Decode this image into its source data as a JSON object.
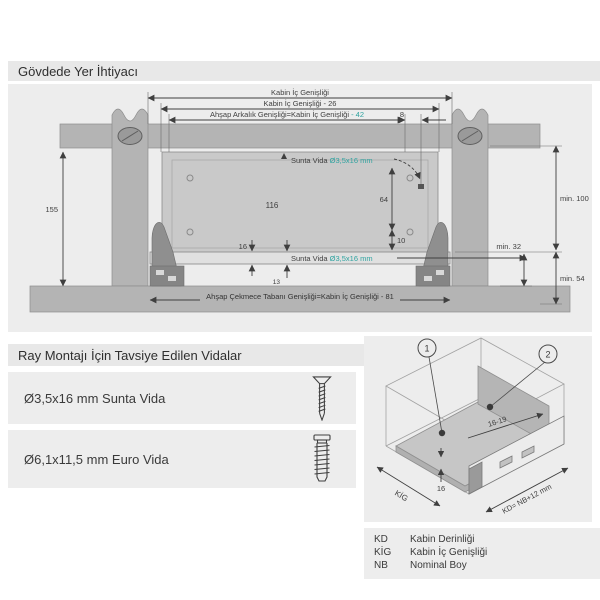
{
  "page": {
    "title": "Gövdede Yer İhtiyacı"
  },
  "drawing": {
    "top1": "Kabin İç Genişliği",
    "top2": "Kabin İç Genişliği - 26",
    "top3_main": "Ahşap Arkalık Genişliği=Kabin İç Genişliği",
    "top3_accent": " - 42",
    "dim8": "8",
    "d155": "155",
    "d116": "116",
    "d64": "64",
    "d10": "10",
    "d16": "16",
    "d13": "13",
    "min100": "min. 100",
    "min54": "min. 54",
    "min32": "min. 32",
    "sunta_prefix": "Sunta Vida ",
    "sunta_size": "Ø3,5x16 mm",
    "bottom_label": "Ahşap Çekmece Tabanı Genişliği=Kabin İç Genişliği - 81"
  },
  "screws": {
    "title": "Ray Montajı İçin Tavsiye Edilen Vidalar",
    "items": [
      {
        "label": "Ø3,5x16 mm Sunta Vida",
        "icon": "countersunk-screw-icon"
      },
      {
        "label": "Ø6,1x11,5 mm Euro Vida",
        "icon": "euro-screw-icon"
      }
    ]
  },
  "iso": {
    "callout1": "1",
    "callout2": "2",
    "dim_back": "16-19",
    "dim16": "16",
    "kig": "KİG",
    "kd": "KD= NB+12 mm"
  },
  "legend": {
    "rows": [
      {
        "abbr": "KD",
        "label": "Kabin Derinliği"
      },
      {
        "abbr": "KİG",
        "label": "Kabin İç Genişliği"
      },
      {
        "abbr": "NB",
        "label": "Nominal Boy"
      }
    ]
  },
  "colors": {
    "accent_teal": "#2fa3a0",
    "panel_bg": "#ededed",
    "header_bg": "#e8e8e8",
    "cabinet_gray": "#b4b4b4",
    "line_dark": "#3f3f3f"
  }
}
